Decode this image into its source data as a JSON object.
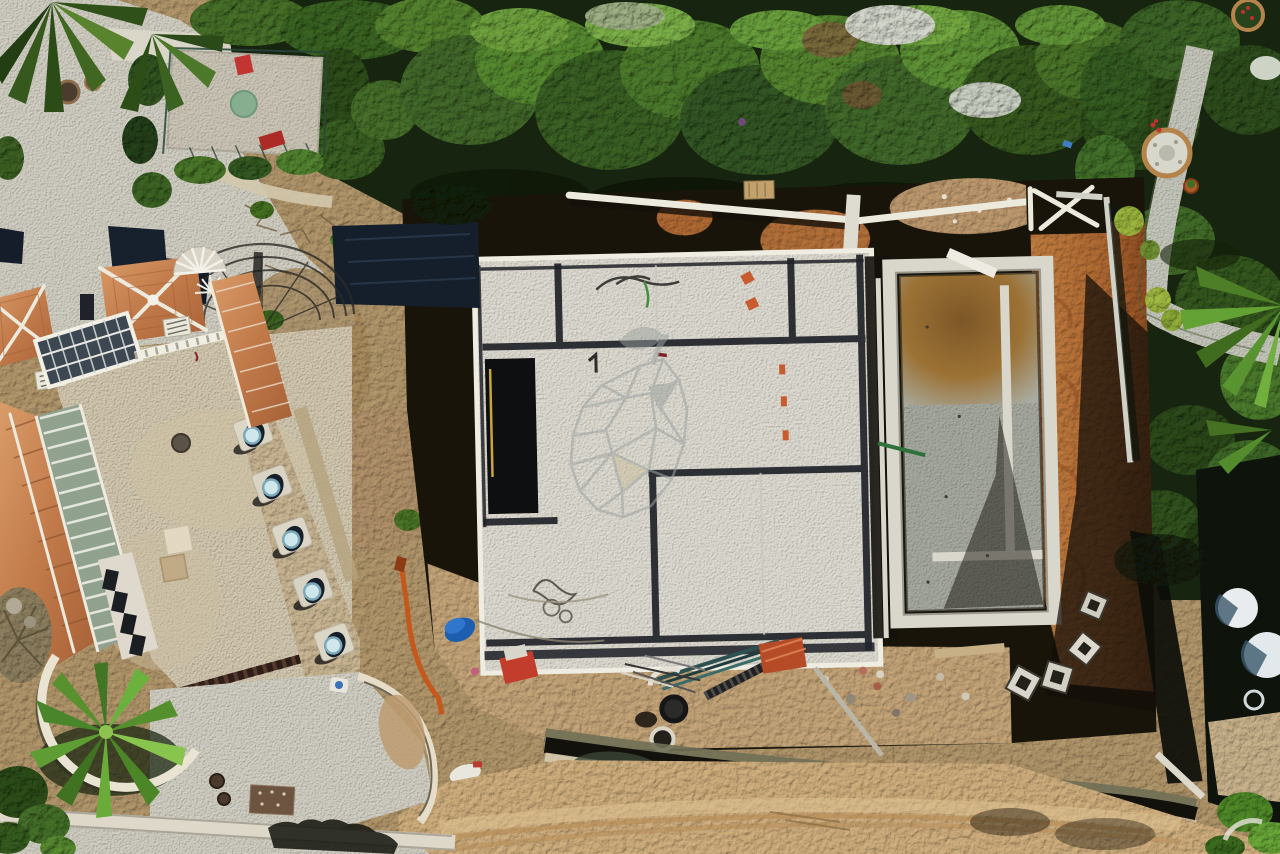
{
  "scene": {
    "title": "Aerial drone photograph of a villa construction site: concrete foundation slab and pool shell, orange excavated earth, neighbouring villa with terracotta pyramid roofs, cobblestone plaza and driveway, gardens, hedges and a sandy dirt road",
    "type": "aerial-photo",
    "regions": [
      "vegetation-hedge-band",
      "right-garden",
      "cobblestone-plaza",
      "playground-court",
      "villa-roofs",
      "glass-pergola",
      "iron-dome-pergola",
      "spiral-staircase",
      "skylight-pad-row",
      "villa-courtyard",
      "palm-garden-bed",
      "driveway",
      "construction-site",
      "foundation-slab",
      "pool-shell",
      "earth-works",
      "retaining-walls",
      "debris-area",
      "boundary-wall",
      "dirt-road",
      "neighbor-property"
    ]
  },
  "watermark": {
    "icon": "geometric-pear-logo",
    "style": "low-poly wireframe pear with solid leaf and stem",
    "color": "#9ba19f",
    "opacity": "0.55"
  },
  "palette": {
    "vegetation_dark": "#16230e",
    "vegetation_mid": "#42682a",
    "vegetation_light": "#72a63c",
    "cobblestone_plaza": "#d4d1c5",
    "courtyard_cobble": "#d5cab1",
    "concrete_slab": "#e2dfd5",
    "formwork_dark": "#1e2127",
    "earth_orange": "#b26a33",
    "excavation_shadow": "#171309",
    "sand_road": "#d2b07e",
    "roof_terracotta": "#c07848",
    "pool_concrete": "#a8aba1",
    "pool_stain": "#7b5526",
    "barrel_blue": "#1c5cb0",
    "pipe_orange": "#c4561c",
    "play_red": "#c23430",
    "skylight_blue": "#cfe6ea"
  }
}
